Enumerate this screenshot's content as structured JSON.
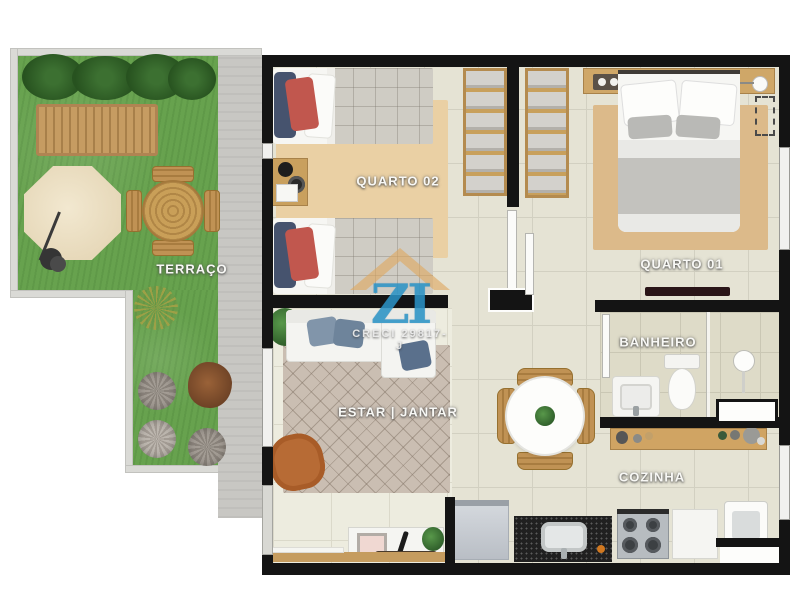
{
  "floorplan": {
    "type": "apartment-top-view-render",
    "rooms": {
      "terraco": {
        "label": "TERRAÇO"
      },
      "quarto02": {
        "label": "QUARTO 02"
      },
      "quarto01": {
        "label": "QUARTO 01"
      },
      "banheiro": {
        "label": "BANHEIRO"
      },
      "estar_jantar": {
        "label": "ESTAR | JANTAR"
      },
      "cozinha": {
        "label": "COZINHA"
      }
    },
    "watermark": {
      "logo_text": "ZI",
      "creci": "CRECI 29817-J",
      "logo_color": "#2d98cc",
      "roof_color": "#dea85f"
    },
    "palette": {
      "wall": "#141414",
      "grass": "#67a24e",
      "floor_tile": "#e5e3d4",
      "wood": "#c9a05e",
      "accent_red_pillow": "#c1574e",
      "accent_navy_pillow": "#46536e",
      "leather_armchair": "#b76b35",
      "background": "#ffffff"
    }
  }
}
